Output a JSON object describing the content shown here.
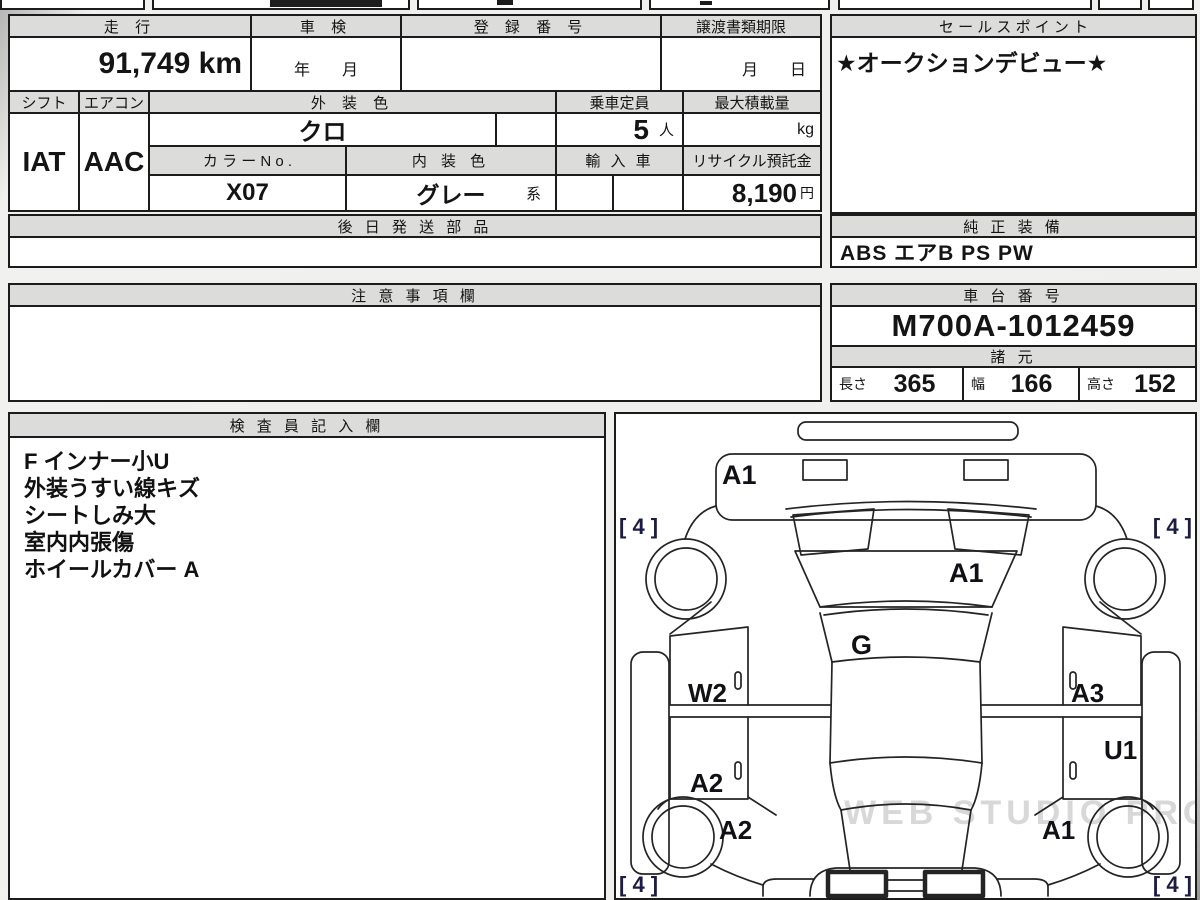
{
  "vehicle": {
    "mileage_header": "走 行",
    "mileage": "91,749 km",
    "inspection_header": "車 検",
    "inspection_value": "年　　月",
    "registration_header": "登 録 番 号",
    "transfer_header": "譲渡書類期限",
    "transfer_value": "月　　日",
    "shift_header": "シフト",
    "shift": "IAT",
    "aircon_header": "エアコン",
    "aircon": "AAC",
    "ext_color_header": "外 装 色",
    "ext_color": "クロ",
    "capacity_header": "乗車定員",
    "capacity": "5",
    "capacity_unit": "人",
    "max_load_header": "最大積載量",
    "max_load_unit": "kg",
    "color_no_header": "カ ラ ー N o .",
    "color_no": "X07",
    "int_color_header": "内 装 色",
    "int_color": "グレー",
    "int_color_suffix": "系",
    "import_header": "輸 入 車",
    "recycle_header": "リサイクル預託金",
    "recycle_value": "8,190",
    "recycle_unit": "円",
    "later_parts_header": "後 日 発 送 部 品"
  },
  "sales_point": {
    "header": "セ ー ル ス ポ イ ン ト",
    "value": "★オークションデビュー★"
  },
  "equipment": {
    "header": "純 正 装 備",
    "value": "ABS エアB PS PW"
  },
  "caution": {
    "header": "注 意 事 項 欄"
  },
  "chassis": {
    "header": "車 台 番 号",
    "value": "M700A-1012459"
  },
  "specs": {
    "header": "諸 元",
    "length_label": "長さ",
    "length": "365",
    "width_label": "幅",
    "width": "166",
    "height_label": "高さ",
    "height": "152"
  },
  "inspector": {
    "header": "検 査 員 記 入 欄",
    "lines": [
      "F インナー小U",
      "外装うすい線キズ",
      "シートしみ大",
      "室内内張傷",
      "ホイールカバー A"
    ]
  },
  "diagram": {
    "labels": {
      "front_bumper": "A1",
      "tire_fl": "[ 4 ]",
      "tire_fr": "[ 4 ]",
      "windshield": "A1",
      "roof": "G",
      "door_fl": "W2",
      "door_fr": "A3",
      "door_rr": "U1",
      "door_rl": "A2",
      "quarter_rl": "A2",
      "quarter_rr": "A1",
      "tire_rl": "[ 4 ]",
      "tire_rr": "[ 4 ]"
    },
    "watermark": "WEB STUDIO PRO"
  }
}
